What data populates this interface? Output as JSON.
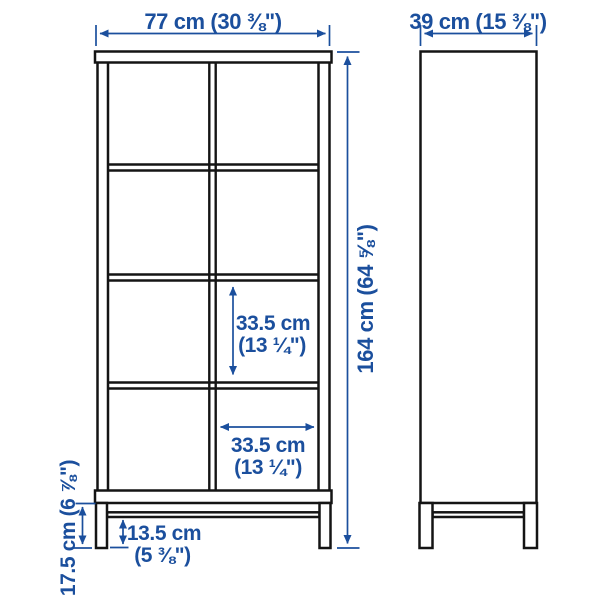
{
  "colors": {
    "dimension_blue": "#1b4f9d",
    "furniture_line": "#141414",
    "background": "#ffffff"
  },
  "front_view": {
    "width": "77 cm (30 ⅜\")",
    "height": "164 cm (64 ⅝\")",
    "inner_cell_height_line1": "33.5 cm",
    "inner_cell_height_line2": "(13 ¼\")",
    "inner_cell_width_line1": "33.5 cm",
    "inner_cell_width_line2": "(13 ¼\")",
    "leg_height": "17.5 cm (6 ⅞\")",
    "rail_clearance_line1": "13.5 cm",
    "rail_clearance_line2": "(5 ⅜\")"
  },
  "side_view": {
    "depth": "39 cm (15 ⅜\")"
  }
}
